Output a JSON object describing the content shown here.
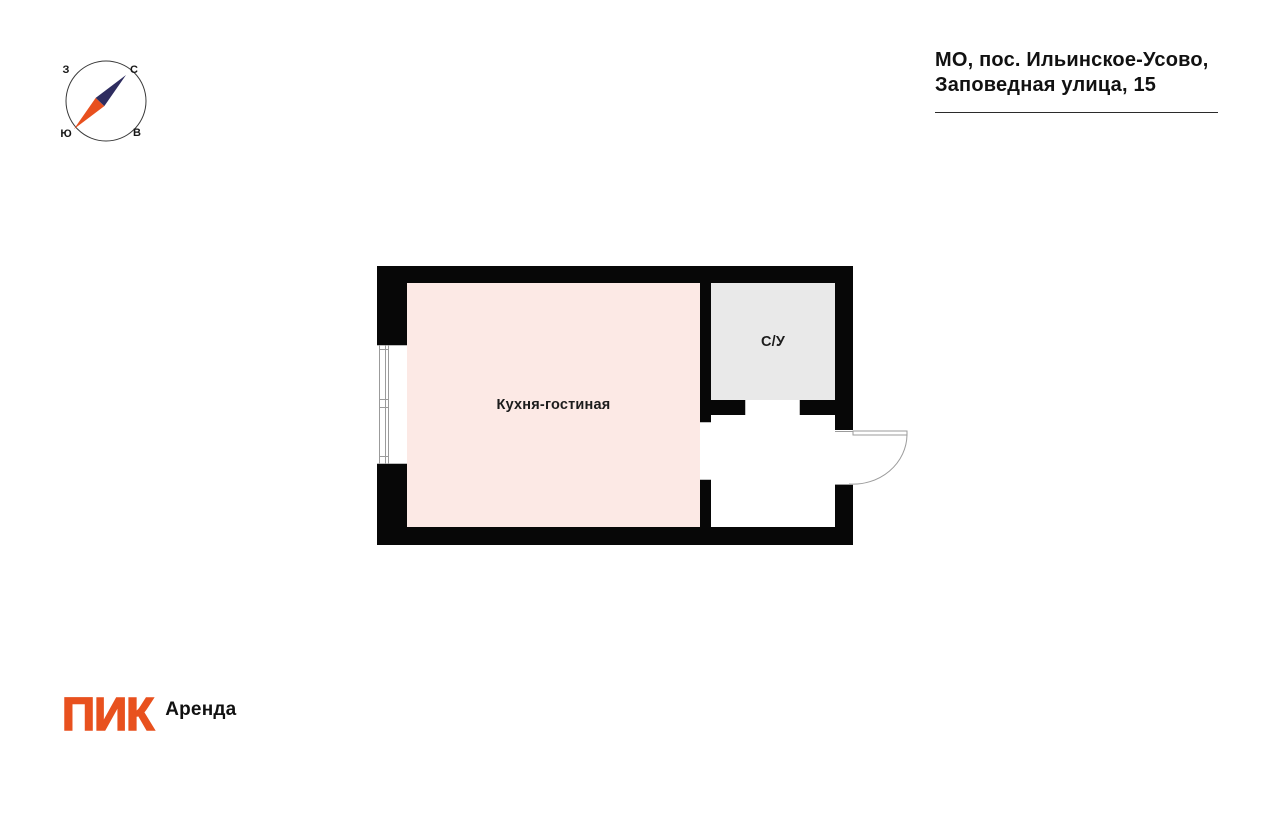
{
  "compass": {
    "labels": {
      "west": "З",
      "north": "С",
      "south": "Ю",
      "east": "В"
    }
  },
  "address": {
    "line1": "МО, пос. Ильинское-Усово,",
    "line2": "Заповедная улица, 15"
  },
  "floor_plan": {
    "rooms": [
      {
        "id": "kitchen-living",
        "label": "Кухня-гостиная",
        "fill": "#fce9e5"
      },
      {
        "id": "bathroom",
        "label": "С/У",
        "fill": "#e9e9e9"
      }
    ]
  },
  "branding": {
    "logo_text": "ПИК",
    "product_text": "Аренда"
  },
  "colors": {
    "accent_orange": "#e8511e",
    "compass_navy": "#2e2c5f",
    "room_pink": "#fce9e5",
    "room_gray": "#e9e9e9",
    "wall_black": "#070707",
    "thin_line_gray": "#9b9b9b"
  }
}
